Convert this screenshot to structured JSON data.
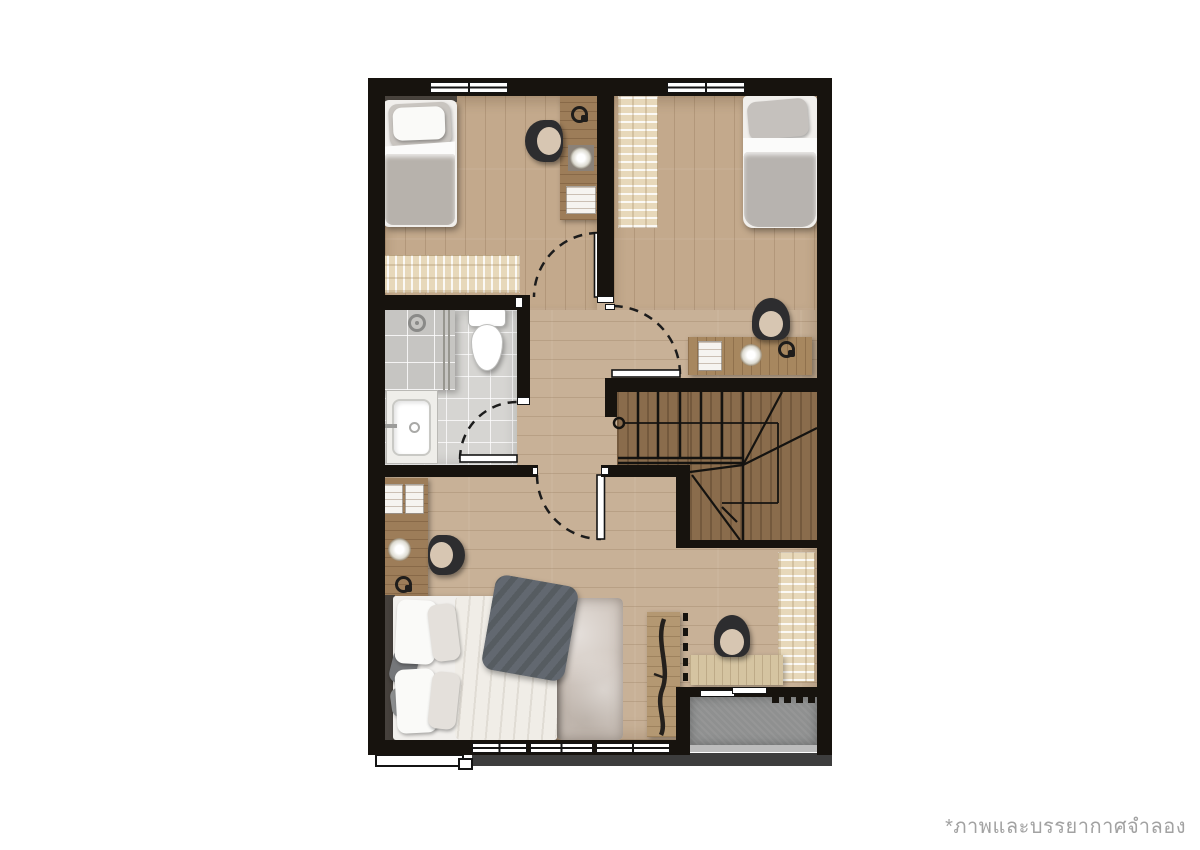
{
  "caption": {
    "text": "*ภาพและบรรยากาศจำลอง"
  },
  "palette": {
    "background": "#ffffff",
    "wall": "#17130e",
    "floor_wood": "#c8b197",
    "bedroom_wood": "#c3a98c",
    "stair_wood": "#8a6c4c",
    "bathroom_tile": "#d6d5d2",
    "shower_tile": "#c6c5c2",
    "balcony_concrete": "#8f9090",
    "rug_beige": "#e7d8ba",
    "shag_rug": "#cfc5bd",
    "desk_wood": "#9d7d59",
    "desk_light": "#d5c4a1",
    "mattress_white": "#f1efec",
    "blanket_gray": "#b7b2ac",
    "throw_dark": "#5c6166",
    "chair_black": "#2d2d2f",
    "chair_seat": "#d7c6b2",
    "under_shadow": "#3d3d3d",
    "caption_text": "#a2a2a2"
  },
  "objects": {
    "type": "floor-plan",
    "rooms": [
      "bedroom-top-left",
      "bedroom-top-right",
      "bathroom",
      "hallway",
      "stairwell",
      "master-bedroom",
      "balcony"
    ],
    "furniture": [
      "single-bed",
      "single-bed",
      "double-bed",
      "desk",
      "desk",
      "desk",
      "desk",
      "office-chair",
      "office-chair",
      "office-chair",
      "office-chair",
      "toilet",
      "sink-vanity",
      "shower",
      "rug",
      "rug",
      "rug",
      "shag-rug",
      "tv-console",
      "staircase"
    ],
    "openings": [
      "window",
      "window",
      "window",
      "sliding-door",
      "swing-door",
      "swing-door",
      "swing-door",
      "swing-door"
    ]
  }
}
